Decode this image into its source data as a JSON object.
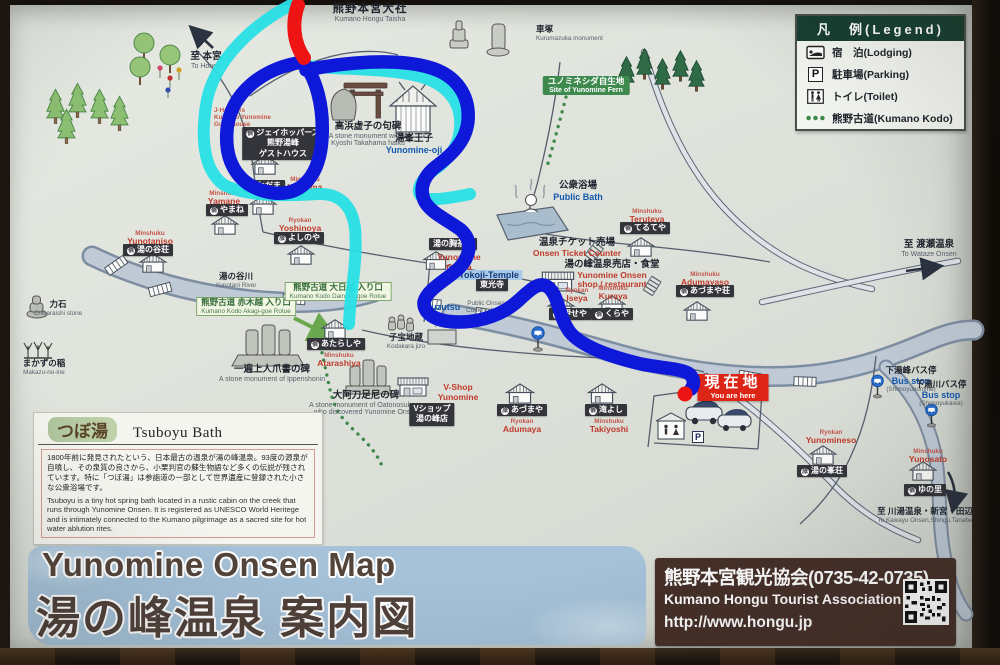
{
  "legend": {
    "title": "凡　例(Legend)",
    "items": [
      {
        "icon": "lodging-icon",
        "label": "宿　泊(Lodging)"
      },
      {
        "icon": "parking-icon",
        "label": "駐車場(Parking)",
        "icon_letter": "P"
      },
      {
        "icon": "toilet-icon",
        "label": "トイレ(Toilet)"
      },
      {
        "icon": "kumano-kodo-dots-icon",
        "label": "熊野古道(Kumano Kodo)"
      }
    ]
  },
  "title_block": {
    "en": "Yunomine Onsen Map",
    "ja": "湯の峰温泉  案内図"
  },
  "tourist_association": {
    "name_ja": "熊野本宮観光協会(0735-42-0735)",
    "name_en": "Kumano Hongu Tourist Association",
    "url": "http://www.hongu.jp"
  },
  "tsuboyu": {
    "title_ja": "つぼ湯",
    "title_en": "Tsuboyu Bath",
    "body_ja": "1800年前に発見されたという、日本最古の温泉が湯の峰温泉。93度の源泉が自噴し、その泉質の良さから、小栗判官の蘇生物語など多くの伝説が残されています。特に「つぼ湯」は参詣道の一部として世界遺産に登録された小さな公衆浴場です。",
    "body_en": "Tsuboyu is a tiny hot spring bath located in a rustic cabin on the creek that runs through Yunomine Onsen. It is registered as UNESCO World Heritege and is intimately connected to the Kumano pilgrimage as a sacred site for hot water ablution rites."
  },
  "colors": {
    "route_blue": "#0d18d8",
    "route_cyan": "#28e0e6",
    "route_red": "#ee1414",
    "board_bg": "#dee2db",
    "legend_header_green": "#173f31",
    "you_are_here_red": "#dd2517",
    "title_brown": "#53443a",
    "title_brush_blue": "#a5c2d9"
  },
  "labels": [
    {
      "name": "label-kumano-hongu-taisha",
      "x": 370,
      "y": 3,
      "parts": [
        {
          "cls": "ja-lg",
          "text": "熊野本宮大社"
        },
        {
          "cls": "en",
          "text": "Kumano Hongu Taisha"
        }
      ]
    },
    {
      "name": "label-kurumazuka",
      "x": 536,
      "y": 25,
      "align": "left",
      "parts": [
        {
          "cls": "ja-sm",
          "text": "車塚"
        },
        {
          "cls": "en-xs",
          "text": "Kurumazuka monument"
        }
      ]
    },
    {
      "name": "label-to-hongu",
      "x": 206,
      "y": 52,
      "parts": [
        {
          "cls": "ja",
          "text": "至 本宮"
        },
        {
          "cls": "en",
          "text": "To Hongu"
        }
      ]
    },
    {
      "name": "label-yunomine-fern",
      "x": 586,
      "y": 76,
      "frame": "sgreen",
      "parts": [
        {
          "cls": "sg-ja",
          "text": "ユノミネシダ自生地"
        },
        {
          "cls": "sg-en",
          "text": "Site of Yunomine Fern"
        }
      ]
    },
    {
      "name": "label-jhoppers-name",
      "x": 214,
      "y": 107,
      "align": "left",
      "parts": [
        {
          "cls": "red-sm",
          "text": "J-Hoppers"
        },
        {
          "cls": "red-sm",
          "text": "Kumano Yunomine"
        },
        {
          "cls": "red-sm",
          "text": "Guesthouse"
        }
      ]
    },
    {
      "name": "label-jhoppers-box",
      "x": 283,
      "y": 127,
      "frame": "dark",
      "parts": [
        {
          "cls": "bx",
          "prefix": "宿",
          "text": "ジェイホッパーズ"
        },
        {
          "cls": "bx",
          "text": "熊野湯峰"
        },
        {
          "cls": "bx",
          "text": "ゲストハウス"
        }
      ]
    },
    {
      "name": "label-takahama-haiku",
      "x": 368,
      "y": 122,
      "parts": [
        {
          "cls": "ja",
          "text": "高浜虚子の句碑"
        },
        {
          "cls": "en",
          "text": "A stone monument with a"
        },
        {
          "cls": "en",
          "text": "Kyoshi Takahama haiku"
        }
      ]
    },
    {
      "name": "label-yunomine-oji",
      "x": 414,
      "y": 134,
      "parts": [
        {
          "cls": "ja",
          "text": "湯峯王子"
        },
        {
          "cls": "en-blue",
          "text": "Yunomine-oji"
        }
      ]
    },
    {
      "name": "label-public-bath",
      "x": 578,
      "y": 181,
      "parts": [
        {
          "cls": "ja",
          "text": "公衆浴場"
        },
        {
          "cls": "en-blue",
          "text": "Public Bath"
        }
      ]
    },
    {
      "name": "label-wadama-box",
      "x": 264,
      "y": 180,
      "frame": "dark",
      "parts": [
        {
          "cls": "bx",
          "prefix": "宿",
          "text": "わだま"
        }
      ]
    },
    {
      "name": "label-wadama-name",
      "x": 305,
      "y": 176,
      "parts": [
        {
          "cls": "red-sm",
          "text": "Minshuku"
        },
        {
          "cls": "red",
          "text": "Wadama"
        }
      ]
    },
    {
      "name": "label-yamane-name",
      "x": 224,
      "y": 190,
      "parts": [
        {
          "cls": "red-sm",
          "text": "Minshuku"
        },
        {
          "cls": "red",
          "text": "Yamane"
        }
      ]
    },
    {
      "name": "label-yamane-box",
      "x": 227,
      "y": 204,
      "frame": "dark",
      "parts": [
        {
          "cls": "bx",
          "prefix": "宿",
          "text": "やまね"
        }
      ]
    },
    {
      "name": "label-yoshinoya-name",
      "x": 300,
      "y": 217,
      "parts": [
        {
          "cls": "red-sm",
          "text": "Ryokan"
        },
        {
          "cls": "red",
          "text": "Yoshinoya"
        }
      ]
    },
    {
      "name": "label-yoshinoya-box",
      "x": 299,
      "y": 232,
      "frame": "dark",
      "parts": [
        {
          "cls": "bx",
          "prefix": "旅",
          "text": "よしのや"
        }
      ]
    },
    {
      "name": "label-yunotaniso-name",
      "x": 150,
      "y": 230,
      "parts": [
        {
          "cls": "red-sm",
          "text": "Minshuku"
        },
        {
          "cls": "red",
          "text": "Yunotaniso"
        }
      ]
    },
    {
      "name": "label-yunotaniso-box",
      "x": 148,
      "y": 244,
      "frame": "dark",
      "parts": [
        {
          "cls": "bx",
          "prefix": "宿",
          "text": "湯の谷荘"
        }
      ]
    },
    {
      "name": "label-yunotani-river",
      "x": 236,
      "y": 272,
      "parts": [
        {
          "cls": "ja-sm",
          "text": "湯の谷川"
        },
        {
          "cls": "en-xs",
          "text": "Yunotani River"
        }
      ]
    },
    {
      "name": "label-teruteya-name",
      "x": 647,
      "y": 208,
      "parts": [
        {
          "cls": "red-sm",
          "text": "Minshuku"
        },
        {
          "cls": "red",
          "text": "Teruteya"
        }
      ]
    },
    {
      "name": "label-teruteya-box",
      "x": 645,
      "y": 222,
      "frame": "dark",
      "parts": [
        {
          "cls": "bx",
          "prefix": "宿",
          "text": "てるてや"
        }
      ]
    },
    {
      "name": "label-onsen-ticket",
      "x": 577,
      "y": 238,
      "parts": [
        {
          "cls": "ja",
          "text": "温泉チケット売場"
        },
        {
          "cls": "red",
          "text": "Onsen Ticket Counter"
        }
      ]
    },
    {
      "name": "label-yunomune-chaya-box",
      "x": 453,
      "y": 238,
      "frame": "dark",
      "parts": [
        {
          "cls": "bx",
          "text": "湯の胸茶屋"
        }
      ]
    },
    {
      "name": "label-yunomune-chaya-name",
      "x": 459,
      "y": 253,
      "parts": [
        {
          "cls": "red",
          "text": "Yunomune"
        },
        {
          "cls": "red",
          "text": "Chaya"
        }
      ]
    },
    {
      "name": "label-tokoji",
      "x": 489,
      "y": 265,
      "parts": [
        {
          "cls": "bluehl",
          "text": "Tokoji-Temple"
        }
      ]
    },
    {
      "name": "label-tokoji-box",
      "x": 492,
      "y": 279,
      "frame": "dark",
      "parts": [
        {
          "cls": "bx",
          "text": "東光寺"
        }
      ]
    },
    {
      "name": "label-yunomine-shop",
      "x": 612,
      "y": 260,
      "parts": [
        {
          "cls": "ja",
          "text": "湯の峰温泉売店・食堂"
        },
        {
          "cls": "red",
          "text": "Yunomine Onsen"
        },
        {
          "cls": "red",
          "text": "shop / restaurant"
        }
      ]
    },
    {
      "name": "label-adumayaso-name",
      "x": 705,
      "y": 271,
      "parts": [
        {
          "cls": "red-sm",
          "text": "Minshuku"
        },
        {
          "cls": "red",
          "text": "Adumayaso"
        }
      ]
    },
    {
      "name": "label-adumayaso-box",
      "x": 705,
      "y": 285,
      "frame": "dark",
      "parts": [
        {
          "cls": "bx",
          "prefix": "宿",
          "text": "あづまや荘"
        }
      ]
    },
    {
      "name": "label-to-wataze",
      "x": 929,
      "y": 240,
      "parts": [
        {
          "cls": "ja",
          "text": "至 渡瀬温泉"
        },
        {
          "cls": "en",
          "text": "To Wataze Onsen"
        }
      ]
    },
    {
      "name": "label-iseya-name",
      "x": 577,
      "y": 287,
      "parts": [
        {
          "cls": "red-sm",
          "text": "Ryokan"
        },
        {
          "cls": "red",
          "text": "Iseya"
        }
      ]
    },
    {
      "name": "label-iseya-box",
      "x": 570,
      "y": 308,
      "frame": "dark",
      "parts": [
        {
          "cls": "bx",
          "prefix": "旅",
          "text": "伊せや"
        }
      ]
    },
    {
      "name": "label-kuraya-name",
      "x": 613,
      "y": 285,
      "parts": [
        {
          "cls": "red-sm",
          "text": "Minshuku"
        },
        {
          "cls": "red",
          "text": "Kuraya"
        }
      ]
    },
    {
      "name": "label-kuraya-box",
      "x": 612,
      "y": 308,
      "frame": "dark",
      "parts": [
        {
          "cls": "bx",
          "prefix": "宿",
          "text": "くらや"
        }
      ]
    },
    {
      "name": "label-yuzutsu",
      "x": 443,
      "y": 302,
      "parts": [
        {
          "cls": "en-blue",
          "text": "Yuzutsu"
        }
      ]
    },
    {
      "name": "label-yuzutsu-desc",
      "x": 486,
      "y": 300,
      "parts": [
        {
          "cls": "en-xs",
          "text": "Public Onsen"
        },
        {
          "cls": "en-xs",
          "text": "Cooking basin"
        }
      ]
    },
    {
      "name": "label-yuzutsu-ja",
      "x": 470,
      "y": 317,
      "parts": [
        {
          "cls": "ja-sm",
          "text": "湯筒"
        }
      ]
    },
    {
      "name": "label-kodakara-jizo",
      "x": 406,
      "y": 333,
      "parts": [
        {
          "cls": "ja-sm",
          "text": "子宝地蔵"
        },
        {
          "cls": "en-xs",
          "text": "Kodakara jizo"
        }
      ]
    },
    {
      "name": "label-akagi-goe",
      "x": 246,
      "y": 297,
      "frame": "green",
      "parts": [
        {
          "cls": "g-ja",
          "text": "熊野古道 赤木越 入り口"
        },
        {
          "cls": "g-en",
          "text": "Kumano Kodo Akagi-goe Rotue"
        }
      ]
    },
    {
      "name": "label-dainichi-goe",
      "x": 338,
      "y": 282,
      "frame": "green",
      "parts": [
        {
          "cls": "g-ja",
          "text": "熊野古道 大日越 入り口"
        },
        {
          "cls": "g-en",
          "text": "Kumano Kodo Dainichi-goe Rotue"
        }
      ]
    },
    {
      "name": "label-ippen-monument",
      "x": 272,
      "y": 365,
      "parts": [
        {
          "cls": "ja",
          "text": "一遍上人爪書の碑"
        },
        {
          "cls": "en",
          "text": "A stone monument of Ippenshonin"
        }
      ]
    },
    {
      "name": "label-atarashiya-box",
      "x": 336,
      "y": 338,
      "frame": "dark",
      "parts": [
        {
          "cls": "bx",
          "prefix": "宿",
          "text": "あたらしや"
        }
      ]
    },
    {
      "name": "label-atarashiya-name",
      "x": 339,
      "y": 352,
      "parts": [
        {
          "cls": "red-sm",
          "text": "Minshuku"
        },
        {
          "cls": "red",
          "text": "Atarashiya"
        }
      ]
    },
    {
      "name": "label-oatonosukune",
      "x": 366,
      "y": 391,
      "parts": [
        {
          "cls": "ja",
          "text": "大阿刀足尼の碑"
        },
        {
          "cls": "en",
          "text": "A stone monument of Oatonosukune"
        },
        {
          "cls": "en",
          "text": "who discovered Yunomine Onsen"
        }
      ]
    },
    {
      "name": "label-vshop-name",
      "x": 458,
      "y": 383,
      "parts": [
        {
          "cls": "red",
          "text": "V-Shop"
        },
        {
          "cls": "red",
          "text": "Yunomine"
        }
      ]
    },
    {
      "name": "label-vshop-box",
      "x": 432,
      "y": 403,
      "frame": "dark",
      "parts": [
        {
          "cls": "bx",
          "text": "Vショップ"
        },
        {
          "cls": "bx",
          "text": "湯の峰店"
        }
      ]
    },
    {
      "name": "label-adumaya-box",
      "x": 522,
      "y": 404,
      "frame": "dark",
      "parts": [
        {
          "cls": "bx",
          "prefix": "旅",
          "text": "あづまや"
        }
      ]
    },
    {
      "name": "label-adumaya-name",
      "x": 522,
      "y": 418,
      "parts": [
        {
          "cls": "red-sm",
          "text": "Ryokan"
        },
        {
          "cls": "red",
          "text": "Adumaya"
        }
      ]
    },
    {
      "name": "label-takiyoshi-box",
      "x": 606,
      "y": 404,
      "frame": "dark",
      "parts": [
        {
          "cls": "bx",
          "prefix": "宿",
          "text": "滝よし"
        }
      ]
    },
    {
      "name": "label-takiyoshi-name",
      "x": 609,
      "y": 418,
      "parts": [
        {
          "cls": "red-sm",
          "text": "Minshuku"
        },
        {
          "cls": "red",
          "text": "Takiyoshi"
        }
      ]
    },
    {
      "name": "label-you-are-here",
      "x": 733,
      "y": 374,
      "frame": "red",
      "parts": [
        {
          "cls": "gz-ja",
          "text": "現在地"
        },
        {
          "cls": "gz-en",
          "text": "You are here"
        }
      ]
    },
    {
      "name": "label-parking-sign",
      "x": 698,
      "y": 427,
      "parts": [
        {
          "cls": "psign",
          "text": "P"
        }
      ]
    },
    {
      "name": "label-busstop-shimoyunomine",
      "x": 911,
      "y": 366,
      "parts": [
        {
          "cls": "ja-sm",
          "text": "下湯峰バス停"
        },
        {
          "cls": "en-blue",
          "text": "Bus stop"
        },
        {
          "cls": "en-xs",
          "text": "(Shimoyunomine)"
        }
      ]
    },
    {
      "name": "label-busstop-shimoyukawa",
      "x": 941,
      "y": 380,
      "parts": [
        {
          "cls": "ja-sm",
          "text": "下湯川バス停"
        },
        {
          "cls": "en-blue",
          "text": "Bus stop"
        },
        {
          "cls": "en-xs",
          "text": "(Shimoyukawa)"
        }
      ]
    },
    {
      "name": "label-yunomineso-name",
      "x": 831,
      "y": 429,
      "parts": [
        {
          "cls": "red-sm",
          "text": "Ryokan"
        },
        {
          "cls": "red",
          "text": "Yunomineso"
        }
      ]
    },
    {
      "name": "label-yunomineso-box",
      "x": 822,
      "y": 465,
      "frame": "dark",
      "parts": [
        {
          "cls": "bx",
          "prefix": "旅",
          "text": "湯の峯荘"
        }
      ]
    },
    {
      "name": "label-yunosato-name",
      "x": 928,
      "y": 448,
      "parts": [
        {
          "cls": "red-sm",
          "text": "Minshuku"
        },
        {
          "cls": "red",
          "text": "Yunosato"
        }
      ]
    },
    {
      "name": "label-yunosato-box",
      "x": 925,
      "y": 484,
      "frame": "dark",
      "parts": [
        {
          "cls": "bx",
          "prefix": "宿",
          "text": "ゆの里"
        }
      ]
    },
    {
      "name": "label-to-kawayu",
      "x": 925,
      "y": 507,
      "parts": [
        {
          "cls": "ja-sm",
          "text": "至 川湯温泉・新宮・田辺"
        },
        {
          "cls": "en-xs",
          "text": "To Kawayu Onsen,Shingu,Tanabe"
        }
      ]
    },
    {
      "name": "label-chikaraishi",
      "x": 58,
      "y": 300,
      "parts": [
        {
          "cls": "ja-sm",
          "text": "力石"
        },
        {
          "cls": "en-xs",
          "text": "Chikaraishi stone"
        }
      ]
    },
    {
      "name": "label-makazu-no-ine",
      "x": 44,
      "y": 359,
      "parts": [
        {
          "cls": "ja-sm",
          "text": "まかずの稲"
        },
        {
          "cls": "en-xs",
          "text": "Makazu-no-ine"
        }
      ]
    }
  ]
}
